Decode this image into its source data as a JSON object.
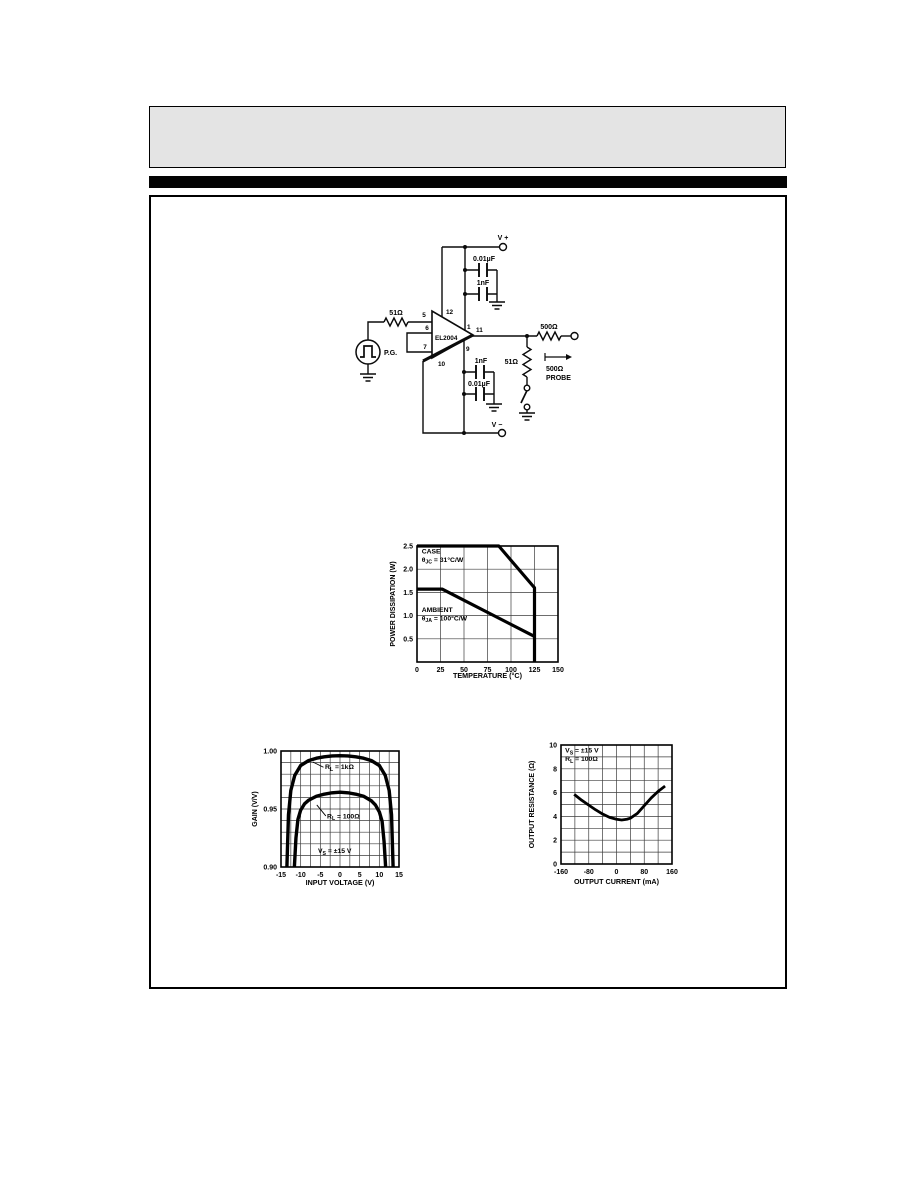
{
  "circuit": {
    "labels": {
      "v_plus": "V +",
      "v_minus": "V −",
      "cap_top_outer": "0.01µF",
      "cap_top_inner": "1nF",
      "cap_bottom_inner": "1nF",
      "cap_bottom_outer": "0.01µF",
      "r_input": "51Ω",
      "r_series_out": "500Ω",
      "r_shunt": "51Ω",
      "probe_r": "500Ω",
      "probe": "PROBE",
      "pg": "P.G.",
      "ic": "EL2004"
    },
    "pins": {
      "p1": "1",
      "p5": "5",
      "p6": "6",
      "p7": "7",
      "p9": "9",
      "p10": "10",
      "p11": "11",
      "p12": "12"
    }
  },
  "chart_data": [
    {
      "id": "power",
      "type": "line",
      "title": "",
      "xlabel": "TEMPERATURE (°C)",
      "ylabel": "POWER DISSIPATION (W)",
      "xlim": [
        0,
        150
      ],
      "ylim": [
        0,
        2.5
      ],
      "xgrid": 25,
      "ygrid": 0.5,
      "grid": true,
      "xticks": [
        {
          "v": 0,
          "l": "0"
        },
        {
          "v": 25,
          "l": "25"
        },
        {
          "v": 50,
          "l": "50"
        },
        {
          "v": 75,
          "l": "75"
        },
        {
          "v": 100,
          "l": "100"
        },
        {
          "v": 125,
          "l": "125"
        },
        {
          "v": 150,
          "l": "150"
        }
      ],
      "yticks": [
        {
          "v": 0.5,
          "l": "0.5"
        },
        {
          "v": 1.0,
          "l": "1.0"
        },
        {
          "v": 1.5,
          "l": "1.5"
        },
        {
          "v": 2.0,
          "l": "2.0"
        },
        {
          "v": 2.5,
          "l": "2.5"
        }
      ],
      "series": [
        {
          "name": "CASE θJC = 31°C/W",
          "points": [
            [
              0,
              2.5
            ],
            [
              87,
              2.5
            ],
            [
              125,
              1.6
            ],
            [
              125,
              0
            ]
          ]
        },
        {
          "name": "AMBIENT θJA = 100°C/W",
          "points": [
            [
              0,
              1.57
            ],
            [
              27,
              1.57
            ],
            [
              125,
              0.55
            ]
          ]
        }
      ],
      "annotations": [
        {
          "x": 5,
          "y": 2.34,
          "anchor": "start",
          "lines": [
            [
              {
                "t": "CASE"
              }
            ],
            [
              {
                "t": "θ"
              },
              {
                "t": "JC",
                "sub": true
              },
              {
                "t": " = 31°C/W"
              }
            ]
          ]
        },
        {
          "x": 5,
          "y": 1.08,
          "anchor": "start",
          "lines": [
            [
              {
                "t": "AMBIENT"
              }
            ],
            [
              {
                "t": "θ"
              },
              {
                "t": "JA",
                "sub": true
              },
              {
                "t": " = 100°C/W"
              }
            ]
          ]
        }
      ]
    },
    {
      "id": "gain",
      "type": "line",
      "title": "",
      "xlabel": "INPUT VOLTAGE (V)",
      "ylabel": "GAIN (V/V)",
      "xlim": [
        -15,
        15
      ],
      "ylim": [
        0.9,
        1.0
      ],
      "xgrid": 2.5,
      "ygrid": 0.01,
      "grid": true,
      "xticks": [
        {
          "v": -15,
          "l": "-15"
        },
        {
          "v": -10,
          "l": "-10"
        },
        {
          "v": -5,
          "l": "-5"
        },
        {
          "v": 0,
          "l": "0"
        },
        {
          "v": 5,
          "l": "5"
        },
        {
          "v": 10,
          "l": "10"
        },
        {
          "v": 15,
          "l": "15"
        }
      ],
      "yticks": [
        {
          "v": 0.9,
          "l": "0.90"
        },
        {
          "v": 0.95,
          "l": "0.95"
        },
        {
          "v": 1.0,
          "l": "1.00"
        }
      ],
      "series": [
        {
          "name": "RL = 1kΩ",
          "points": [
            [
              -13.5,
              0.9
            ],
            [
              -13.1,
              0.945
            ],
            [
              -12.5,
              0.966
            ],
            [
              -11.5,
              0.979
            ],
            [
              -10,
              0.9875
            ],
            [
              -8,
              0.9917
            ],
            [
              -6,
              0.9938
            ],
            [
              -4,
              0.995
            ],
            [
              -2,
              0.9957
            ],
            [
              0,
              0.996
            ],
            [
              2,
              0.9957
            ],
            [
              4,
              0.995
            ],
            [
              6,
              0.9938
            ],
            [
              8,
              0.9917
            ],
            [
              10,
              0.9875
            ],
            [
              11.5,
              0.979
            ],
            [
              12.5,
              0.966
            ],
            [
              13.1,
              0.945
            ],
            [
              13.5,
              0.9
            ]
          ]
        },
        {
          "name": "RL = 100Ω",
          "points": [
            [
              -11.6,
              0.9
            ],
            [
              -11.2,
              0.925
            ],
            [
              -10.7,
              0.941
            ],
            [
              -10,
              0.949
            ],
            [
              -9,
              0.9545
            ],
            [
              -8,
              0.9575
            ],
            [
              -6,
              0.961
            ],
            [
              -4,
              0.9628
            ],
            [
              -2,
              0.964
            ],
            [
              0,
              0.9645
            ],
            [
              2,
              0.964
            ],
            [
              4,
              0.9628
            ],
            [
              6,
              0.961
            ],
            [
              8,
              0.957
            ],
            [
              9,
              0.9535
            ],
            [
              10,
              0.9475
            ],
            [
              10.7,
              0.9395
            ],
            [
              11.2,
              0.922
            ],
            [
              11.6,
              0.9
            ]
          ]
        }
      ],
      "annotations": [
        {
          "x": -3.8,
          "y": 0.9845,
          "anchor": "start",
          "lines": [
            [
              {
                "t": "R"
              },
              {
                "t": "L",
                "sub": true
              },
              {
                "t": " = 1kΩ"
              }
            ]
          ],
          "leader": {
            "x1": -4.2,
            "y1": 0.986,
            "x2": -6.9,
            "y2": 0.9905
          }
        },
        {
          "x": -3.3,
          "y": 0.942,
          "anchor": "start",
          "lines": [
            [
              {
                "t": "R"
              },
              {
                "t": "L",
                "sub": true
              },
              {
                "t": " = 100Ω"
              }
            ]
          ],
          "leader": {
            "x1": -3.6,
            "y1": 0.944,
            "x2": -5.9,
            "y2": 0.9535
          }
        },
        {
          "x": -5.6,
          "y": 0.912,
          "anchor": "start",
          "lines": [
            [
              {
                "t": "V"
              },
              {
                "t": "S",
                "sub": true
              },
              {
                "t": " = ±15 V"
              }
            ]
          ]
        }
      ]
    },
    {
      "id": "outres",
      "type": "line",
      "title": "",
      "xlabel": "OUTPUT CURRENT (mA)",
      "ylabel": "OUTPUT RESISTANCE (Ω)",
      "xlim": [
        -160,
        160
      ],
      "ylim": [
        0,
        10
      ],
      "xgrid": 40,
      "ygrid": 1,
      "grid": true,
      "xticks": [
        {
          "v": -160,
          "l": "-160"
        },
        {
          "v": -80,
          "l": "-80"
        },
        {
          "v": 0,
          "l": "0"
        },
        {
          "v": 80,
          "l": "80"
        },
        {
          "v": 160,
          "l": "160"
        }
      ],
      "yticks": [
        {
          "v": 0,
          "l": "0"
        },
        {
          "v": 2,
          "l": "2"
        },
        {
          "v": 4,
          "l": "4"
        },
        {
          "v": 6,
          "l": "6"
        },
        {
          "v": 8,
          "l": "8"
        },
        {
          "v": 10,
          "l": "10"
        }
      ],
      "series": [
        {
          "name": "VS = ±15V, RL = 100Ω",
          "points": [
            [
              -122,
              5.85
            ],
            [
              -100,
              5.35
            ],
            [
              -80,
              4.95
            ],
            [
              -60,
              4.55
            ],
            [
              -40,
              4.2
            ],
            [
              -20,
              3.92
            ],
            [
              0,
              3.76
            ],
            [
              15,
              3.7
            ],
            [
              30,
              3.76
            ],
            [
              40,
              3.85
            ],
            [
              60,
              4.25
            ],
            [
              80,
              4.9
            ],
            [
              100,
              5.55
            ],
            [
              120,
              6.1
            ],
            [
              140,
              6.55
            ]
          ]
        }
      ],
      "annotations": [
        {
          "x": -148,
          "y": 9.35,
          "anchor": "start",
          "lines": [
            [
              {
                "t": "V"
              },
              {
                "t": "S",
                "sub": true
              },
              {
                "t": " = ±15 V"
              }
            ],
            [
              {
                "t": "R"
              },
              {
                "t": "L",
                "sub": true
              },
              {
                "t": " = 100Ω"
              }
            ]
          ]
        }
      ]
    }
  ]
}
